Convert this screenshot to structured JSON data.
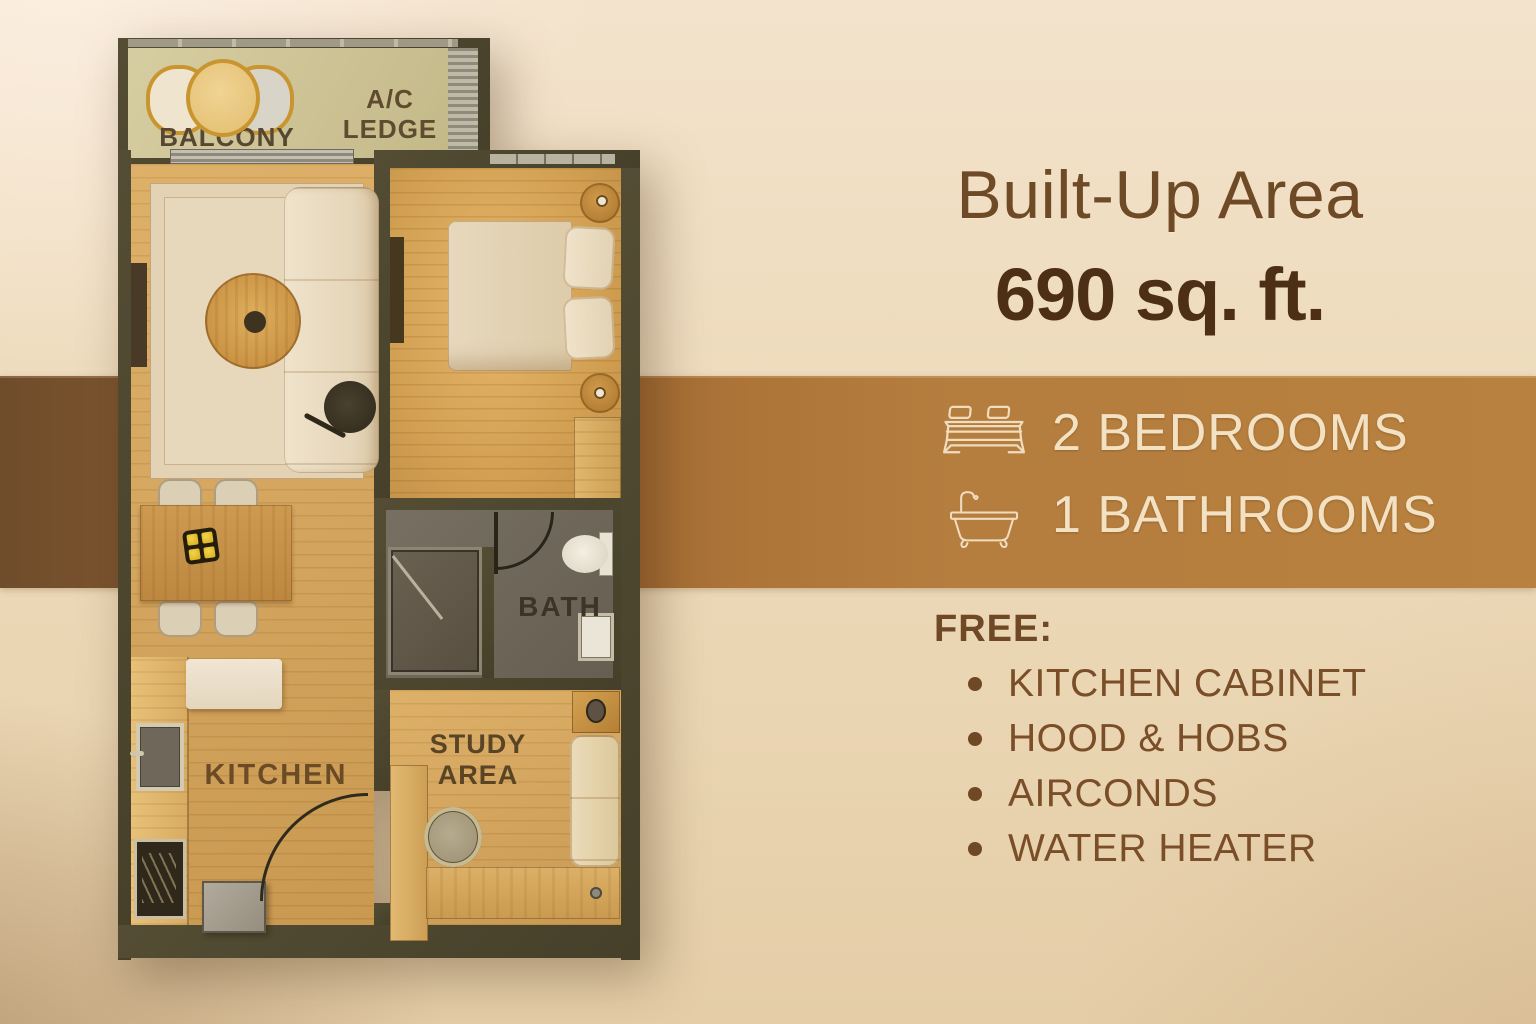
{
  "panel": {
    "title": "Built-Up Area",
    "area_value": "690 sq. ft.",
    "features": [
      {
        "icon": "bed-icon",
        "label": "2 BEDROOMS"
      },
      {
        "icon": "bathtub-icon",
        "label": "1 BATHROOMS"
      }
    ],
    "free": {
      "heading": "FREE:",
      "items": [
        "KITCHEN CABINET",
        "HOOD & HOBS",
        "AIRCONDS",
        "WATER HEATER"
      ]
    }
  },
  "floorplan": {
    "labels": {
      "balcony": "BALCONY",
      "ac_ledge": "A/C LEDGE",
      "bath": "BATH",
      "kitchen": "KITCHEN",
      "study_area": "STUDY AREA"
    }
  },
  "colors": {
    "background": "#eedcbe",
    "accent_band": "#b27a3c",
    "headline_text": "#6e4a26",
    "area_text": "#4c2f15",
    "band_text": "#f3e1c3",
    "list_text": "#7a4e28",
    "wall": "#4c4530",
    "wood_floor": "#d2a45e",
    "balcony_floor": "#ccc396",
    "bath_floor": "#6d665a"
  }
}
